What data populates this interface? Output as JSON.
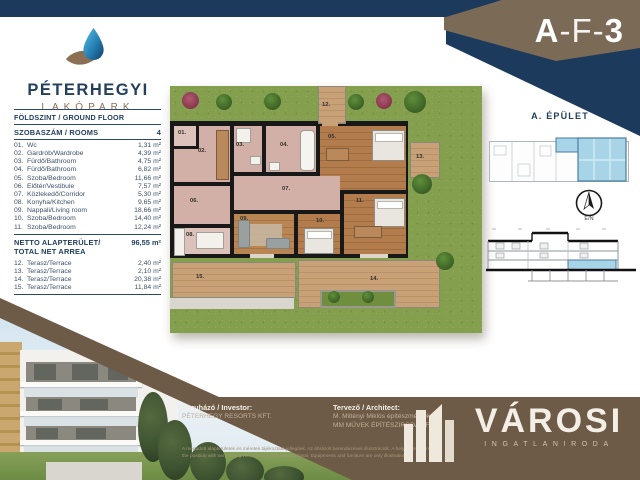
{
  "header": {
    "unit_code": "A-F-3",
    "unit_parts": {
      "building": "A",
      "sep": "-",
      "mid": "F",
      "num": "3"
    }
  },
  "brand_logo": {
    "name": "PÉTERHEGYI",
    "subname": "LAKÓPARK"
  },
  "area_table": {
    "floor_title": "FÖLDSZINT / GROUND FLOOR",
    "rooms_label": "SZOBASZÁM / ROOMS",
    "rooms_count": "4",
    "unit": "m²",
    "rooms": [
      {
        "num": "01.",
        "name": "Wc",
        "area": "1,31"
      },
      {
        "num": "02.",
        "name": "Gardrób/Wardrobe",
        "area": "4,39"
      },
      {
        "num": "03.",
        "name": "Fürdő/Bathroom",
        "area": "4,75"
      },
      {
        "num": "04.",
        "name": "Fürdő/Bathroom",
        "area": "6,82"
      },
      {
        "num": "05.",
        "name": "Szoba/Bedroom",
        "area": "11,66"
      },
      {
        "num": "06.",
        "name": "Előtér/Vestibule",
        "area": "7,57"
      },
      {
        "num": "07.",
        "name": "Közlekedő/Corridor",
        "area": "5,30"
      },
      {
        "num": "08.",
        "name": "Konyha/Kitchen",
        "area": "9,65"
      },
      {
        "num": "09.",
        "name": "Nappali/Living room",
        "area": "18,66"
      },
      {
        "num": "10.",
        "name": "Szoba/Bedroom",
        "area": "14,40"
      },
      {
        "num": "11.",
        "name": "Szoba/Bedroom",
        "area": "12,24"
      }
    ],
    "net_label_1": "NETTO ALAPTERÜLET/",
    "net_label_2": "TOTAL NET ARREA",
    "net_value": "96,55 m²",
    "terraces": [
      {
        "num": "12.",
        "name": "Terasz/Terrace",
        "area": "2,40"
      },
      {
        "num": "13.",
        "name": "Terasz/Terrace",
        "area": "2,10"
      },
      {
        "num": "14.",
        "name": "Terasz/Terrace",
        "area": "20,38"
      },
      {
        "num": "15.",
        "name": "Terasz/Terrace",
        "area": "11,84"
      }
    ]
  },
  "floorplan": {
    "labels": [
      "01.",
      "02.",
      "03.",
      "04.",
      "05.",
      "06.",
      "07.",
      "08.",
      "09.",
      "10.",
      "11.",
      "12.",
      "13.",
      "14.",
      "15."
    ]
  },
  "sidebar": {
    "building_label": "A. ÉPÜLET",
    "compass_label": "É/N"
  },
  "footer": {
    "investor_label": "Beruházó / Investor:",
    "investor_name": "PÉTERHEGY RESORTS KFT.",
    "architect_label": "Tervező / Architect:",
    "architect_name_1": "M. Miltényi Miklós építészmérnök",
    "architect_name_2": "MM MŰVEK ÉPÍTÉSZIRODA KFT.",
    "disclaimer_hu": "A megadott alapterületek és méretek tájékoztató jellegűek. Az ábrázolt berendezések illusztrációk. A helyiségek mérete és",
    "disclaimer_en": "the position with vary. The given data are only informational. Equipments and furniture are only illustration.",
    "brand_name": "VÁROSI",
    "brand_tagline": "INGATLANIRODA"
  },
  "colors": {
    "navy": "#1c3a5c",
    "brown_swoosh": "#7b6a56",
    "footer_brown": "#6e5b47",
    "unit_highlight_blue": "#a8d4e8"
  }
}
